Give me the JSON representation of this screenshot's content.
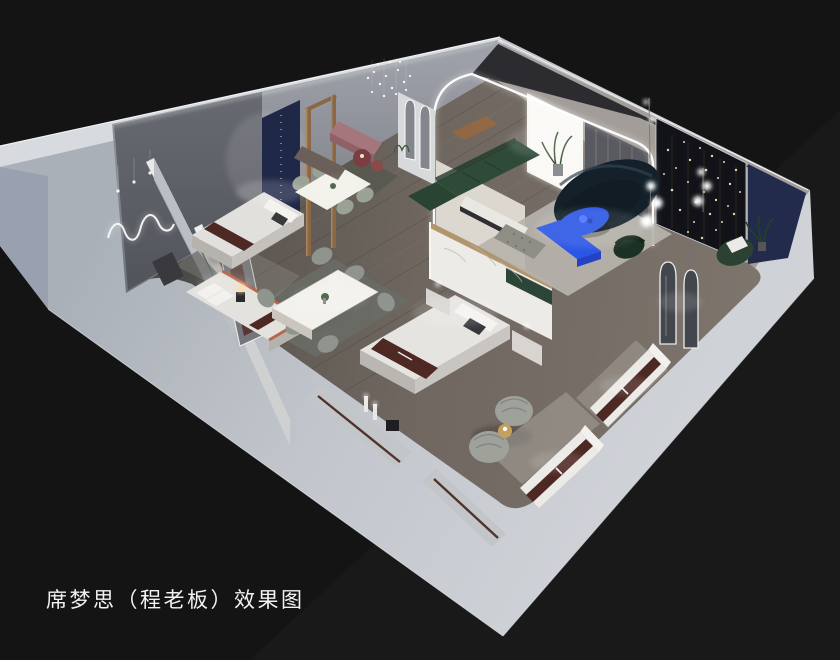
{
  "caption": {
    "text": "席梦思（程老板）效果图"
  },
  "scene": {
    "type": "3d-interior-render",
    "view": "isometric-cutaway-floorplan",
    "subject": "mattress showroom with bedroom, dining and lounge displays"
  },
  "palette": {
    "background": "#141414",
    "background_light": "#1d1d1f",
    "plinth_gray": "#c2c6cc",
    "wall_band": "#d7dade",
    "outer_wall_blue_gray": "#99a1b1",
    "floor_wood": "#6b635b",
    "accent_blue": "#2b55e6",
    "accent_blue_dark": "#2443c4",
    "sofa_green": "#2e4a38",
    "sofa_navy": "#14212a",
    "runner_burgundy": "#4e2823",
    "navy_panel": "#202848",
    "navy_wall": "#232b4c",
    "mauve_bench": "#a5767b",
    "marble_white": "#edebe7",
    "gold_wood": "#8a6847",
    "led_white": "#ffffff"
  }
}
